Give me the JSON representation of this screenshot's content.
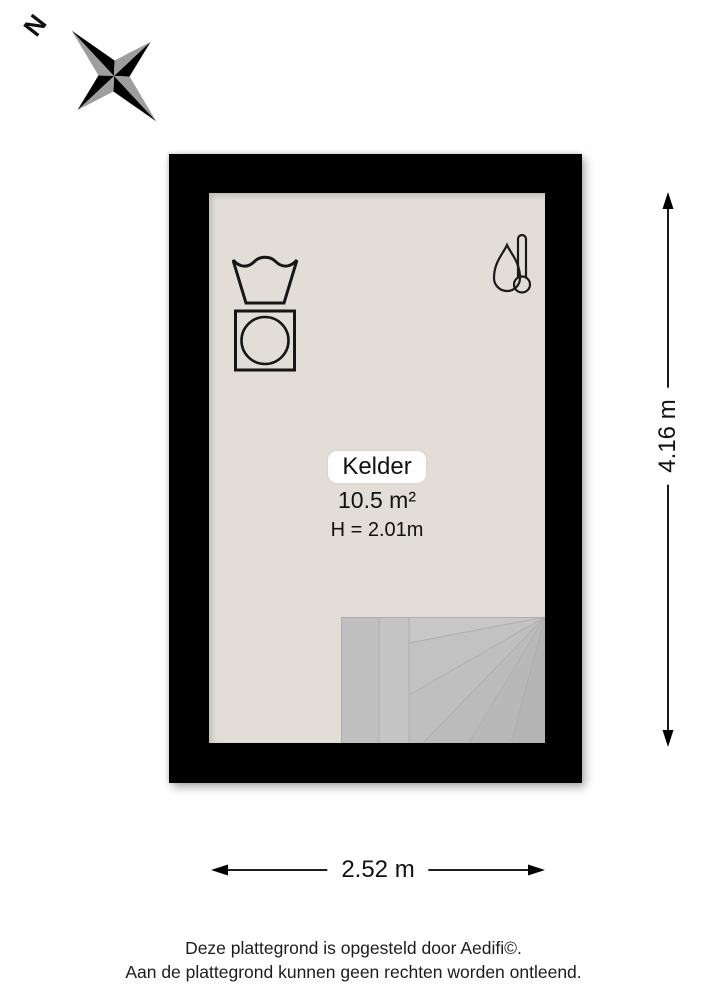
{
  "compass": {
    "north_label": "N"
  },
  "room": {
    "name": "Kelder",
    "area": "10.5 m²",
    "ceiling_height": "H = 2.01m"
  },
  "dimensions": {
    "height_label": "4.16 m",
    "width_label": "2.52 m"
  },
  "footer": {
    "line1": "Deze plattegrond is opgesteld door Aedifi©.",
    "line2": "Aan de plattegrond kunnen geen rechten worden ontleend."
  },
  "colors": {
    "wall": "#000000",
    "floor": "#e2ded7",
    "stairs": "#bdbdbd",
    "compass_gray": "#9e9e9e",
    "label_background": "#fefefe"
  }
}
